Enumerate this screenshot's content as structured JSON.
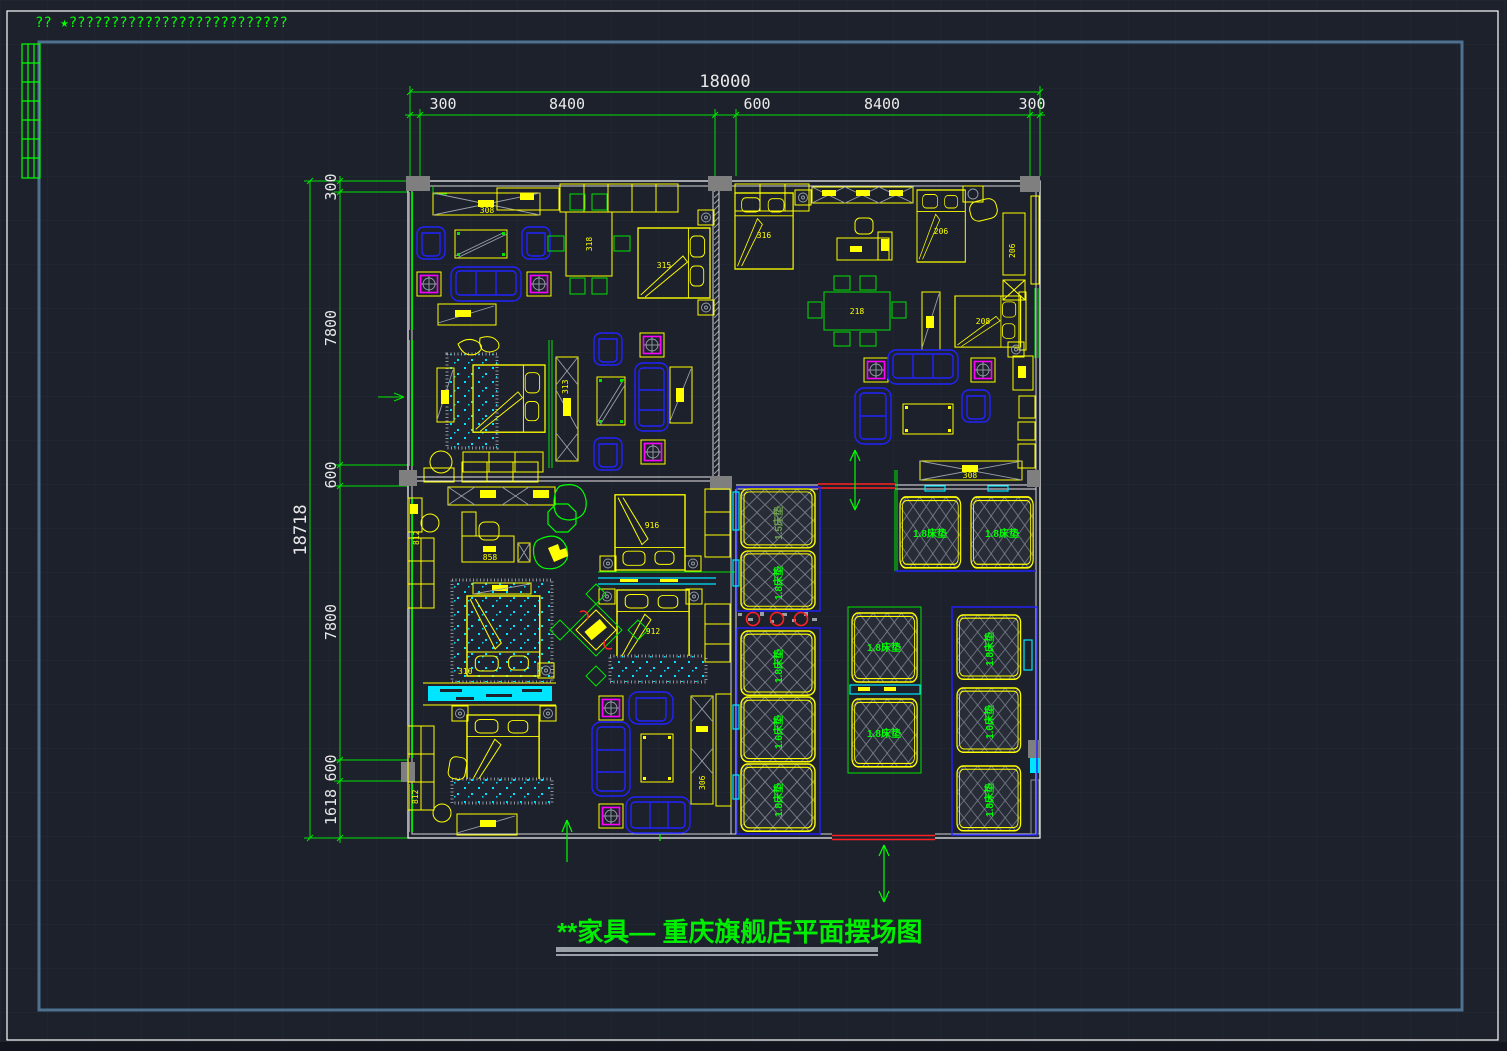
{
  "app": {
    "note_text": "??  ★??????????????????????????",
    "background": "#1c212c",
    "frame_color": "#4e7191",
    "wall_color": "#ffffff",
    "dim_color": "#00e400"
  },
  "title": {
    "text": "**家具— 重庆旗舰店平面摆场图"
  },
  "dimensions": {
    "top": {
      "overall": "18000",
      "segments": [
        "300",
        "8400",
        "600",
        "8400",
        "300"
      ]
    },
    "left": {
      "overall": "18718",
      "segments": [
        "300",
        "7800",
        "600",
        "7800",
        "600",
        "1618"
      ]
    }
  },
  "product_labels": {
    "console_tl": "308",
    "dining_tl": "318",
    "bed_tl": "315",
    "wardrobe_ml": "313",
    "bed_tr_left": "316",
    "bed_tr_top": "206",
    "wardrobe_tr": "206",
    "bed_tr_right": "208",
    "dining_tr": "218",
    "console_tr": "308",
    "desk_bl": "858",
    "bed_bl": "310",
    "cabinet_bl_upper": "812",
    "cabinet_bl_lower": "812",
    "bed_bc_upper": "916",
    "bed_bc_lower": "912",
    "display_bc": "306"
  },
  "mattress_labels": {
    "left": [
      "1.5床垫",
      "1.8床垫",
      "1.8床垫",
      "1.6床垫",
      "1.8床垫"
    ],
    "center": [
      "1.8床垫",
      "1.8床垫"
    ],
    "right": [
      "1.8床垫",
      "1.6床垫",
      "1.8床垫"
    ],
    "top_right": [
      "1.8床垫",
      "1.8床垫"
    ]
  }
}
